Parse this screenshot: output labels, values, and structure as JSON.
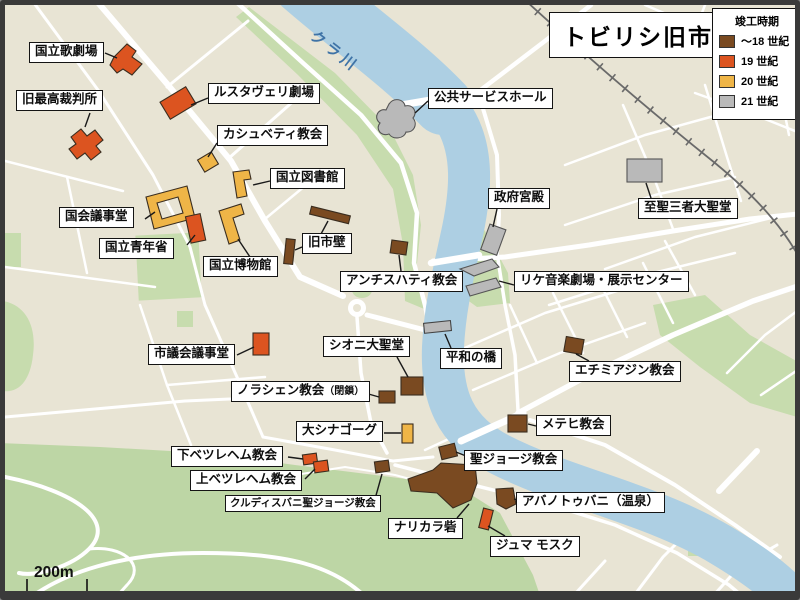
{
  "title": "トビリシ旧市街",
  "legend": {
    "title": "竣工時期",
    "items": [
      {
        "id": "18",
        "label": "～18 世紀",
        "color": "#7a4a21"
      },
      {
        "id": "19",
        "label": "19 世紀",
        "color": "#dc5420"
      },
      {
        "id": "20",
        "label": "20 世紀",
        "color": "#efb547"
      },
      {
        "id": "21",
        "label": "21 世紀",
        "color": "#b9b9b9"
      }
    ]
  },
  "river": {
    "label": "クラ川",
    "water_color": "#adcfe3",
    "label_color": "#3f73a6"
  },
  "scale": {
    "label": "200m"
  },
  "map_colors": {
    "background": "#e8e4d4",
    "road": "#ffffff",
    "park": "#c7dcae",
    "mountain": "#bdd6a5",
    "railway": "#6a6a6a"
  },
  "pois": [
    {
      "name": "国立歌劇場",
      "period": "19"
    },
    {
      "name": "旧最高裁判所",
      "period": "19"
    },
    {
      "name": "ルスタヴェリ劇場",
      "period": "19"
    },
    {
      "name": "カシュベティ教会",
      "period": "20"
    },
    {
      "name": "国立図書館",
      "period": "20"
    },
    {
      "name": "国会議事堂",
      "period": "20"
    },
    {
      "name": "国立青年省",
      "period": "19"
    },
    {
      "name": "国立博物館",
      "period": "20"
    },
    {
      "name": "旧市壁",
      "period": "18"
    },
    {
      "name": "公共サービスホール",
      "period": "21"
    },
    {
      "name": "政府宮殿",
      "period": "21"
    },
    {
      "name": "至聖三者大聖堂",
      "period": "21"
    },
    {
      "name": "リケ音楽劇場・展示センター",
      "period": "21"
    },
    {
      "name": "アンチスハティ教会",
      "period": "18"
    },
    {
      "name": "市議会議事堂",
      "period": "19"
    },
    {
      "name": "シオニ大聖堂",
      "period": "18"
    },
    {
      "name": "平和の橋",
      "period": "21"
    },
    {
      "name": "エチミアジン教会",
      "period": "18"
    },
    {
      "name": "ノラシェン教会",
      "suffix": "（閉鎖）",
      "period": "18"
    },
    {
      "name": "メテヒ教会",
      "period": "18"
    },
    {
      "name": "大シナゴーグ",
      "period": "20"
    },
    {
      "name": "下ベツレヘム教会",
      "period": "19"
    },
    {
      "name": "上ベツレヘム教会",
      "period": "19"
    },
    {
      "name": "クルディスバニ聖ジョージ教会",
      "period": "18"
    },
    {
      "name": "ナリカラ砦",
      "period": "18"
    },
    {
      "name": "聖ジョージ教会",
      "period": "18"
    },
    {
      "name": "アバノトゥバニ（温泉）",
      "period": "18"
    },
    {
      "name": "ジュマ モスク",
      "period": "19"
    }
  ]
}
